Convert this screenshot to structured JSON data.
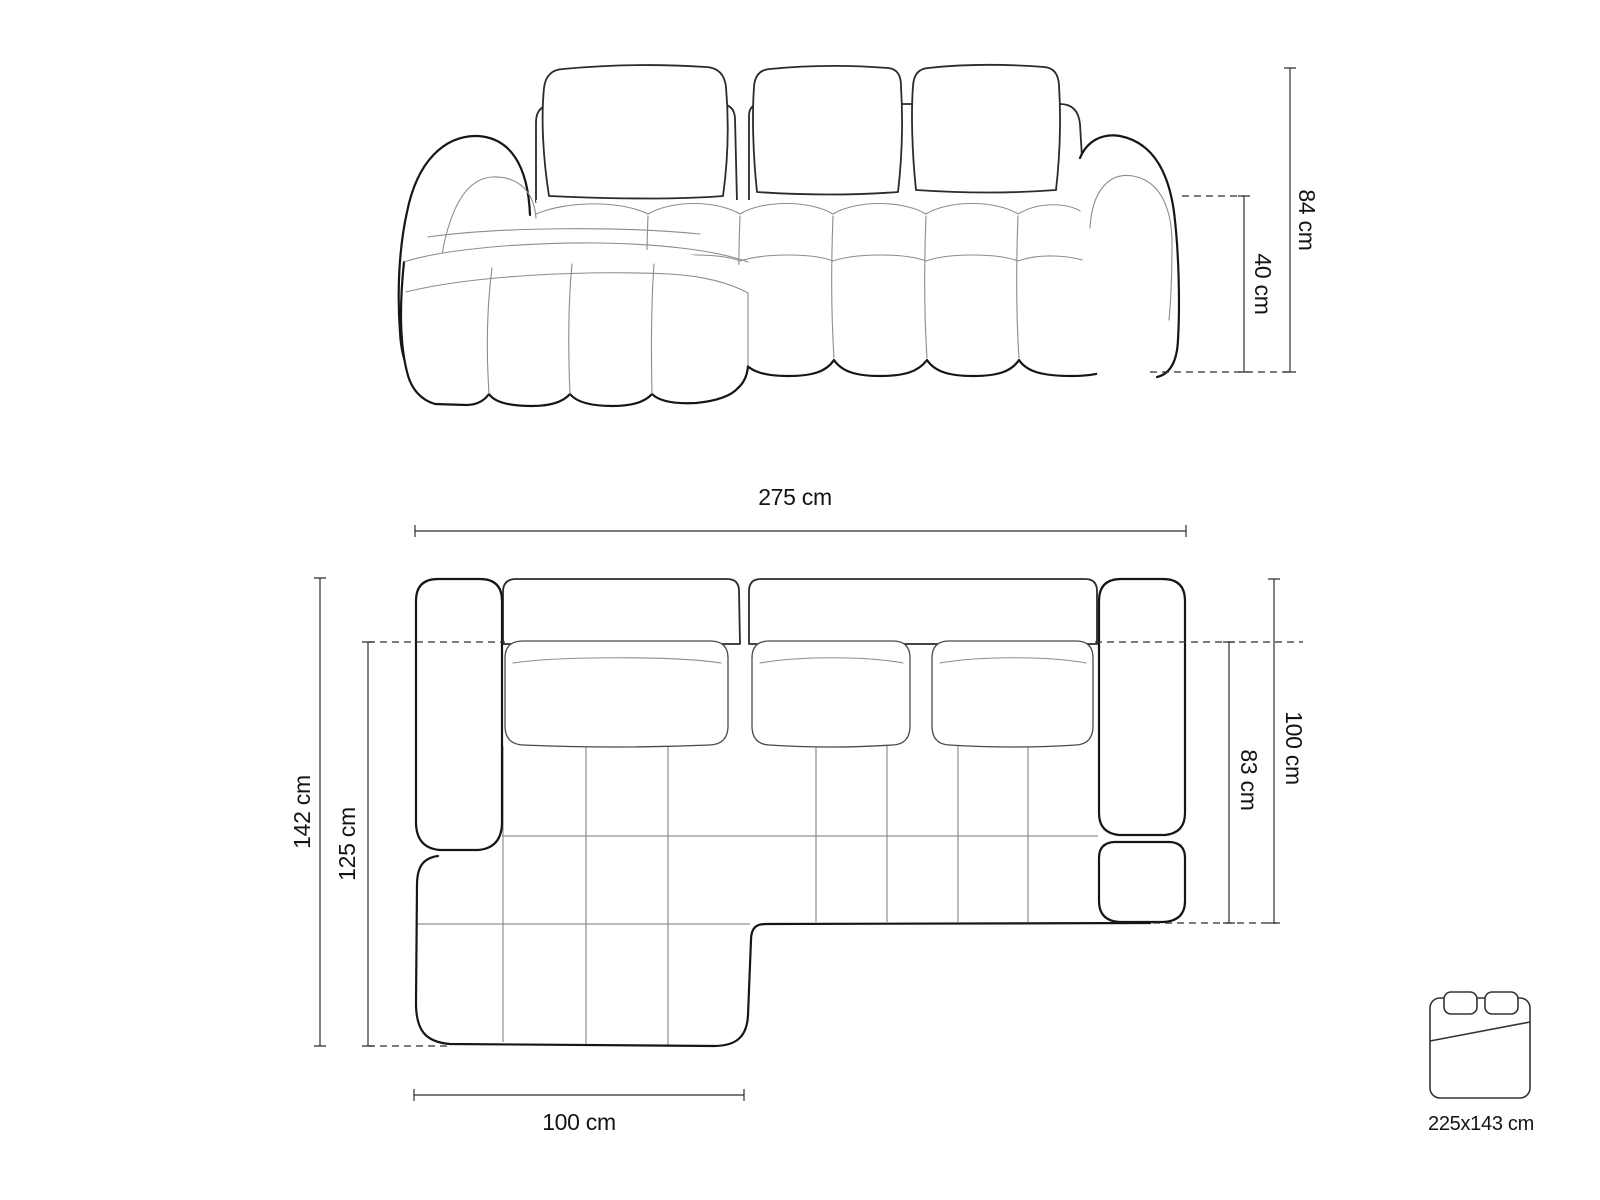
{
  "page": {
    "background": "#ffffff",
    "line_color": "#161616",
    "seam_color": "#8c8c8c",
    "dimension_color": "#2f2f2f"
  },
  "views": {
    "front_view": "sofa-front-view",
    "top_view": "sofa-top-view"
  },
  "dimensions": {
    "height_total": "84 cm",
    "seat_height": "40 cm",
    "width_total": "275 cm",
    "depth_total": "142 cm",
    "chaise_depth_inner": "125 cm",
    "depth_main": "100 cm",
    "depth_inner": "83 cm",
    "chaise_width": "100 cm",
    "sleeping_area": "225x143 cm"
  }
}
